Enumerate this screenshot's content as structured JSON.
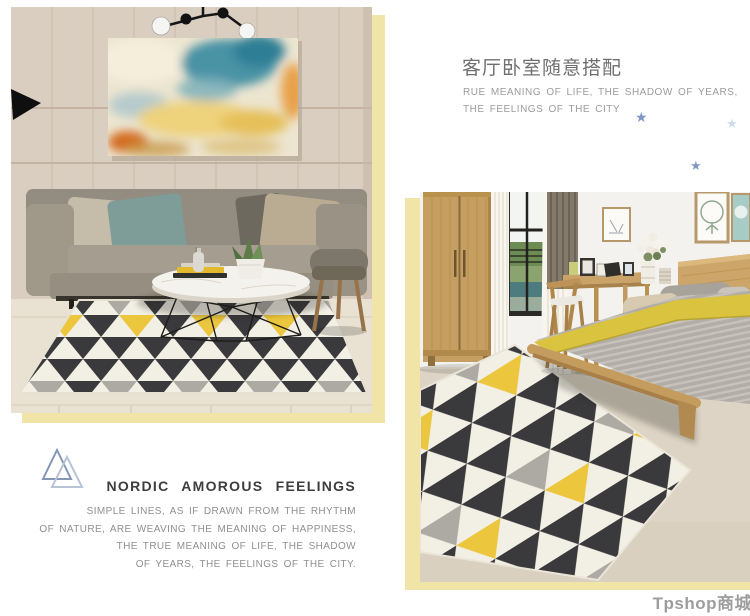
{
  "right_section": {
    "heading_cn": "客厅卧室随意搭配",
    "caption_lines": [
      "RUE MEANING OF LIFE, THE SHADOW OF YEARS,",
      "THE FEELINGS OF THE CITY"
    ]
  },
  "left_section": {
    "title": "NORDIC AMOROUS FEELINGS",
    "lines": [
      "SIMPLE LINES, AS IF DRAWN FROM THE RHYTHM",
      "OF NATURE, ARE WEAVING THE MEANING OF HAPPINESS,",
      "THE TRUE MEANING OF LIFE, THE SHADOW",
      "OF YEARS, THE FEELINGS OF THE CITY."
    ]
  },
  "watermark": {
    "text": "Tpshop商城"
  },
  "decor": {
    "star_glyph": "★",
    "stars": [
      {
        "name": "star-icon",
        "color": "#7e97c6"
      },
      {
        "name": "star-icon-faded",
        "color": "#cfdaeb"
      },
      {
        "name": "star-icon",
        "color": "#7e97c6"
      }
    ],
    "logo": "triangle-mountains-logo",
    "accent_frame_color": "#f1e4a7",
    "rug_colors": {
      "dark": "#3a393b",
      "light": "#f2efe5",
      "gray": "#ada9a3",
      "yellow": "#ecc63d"
    }
  }
}
